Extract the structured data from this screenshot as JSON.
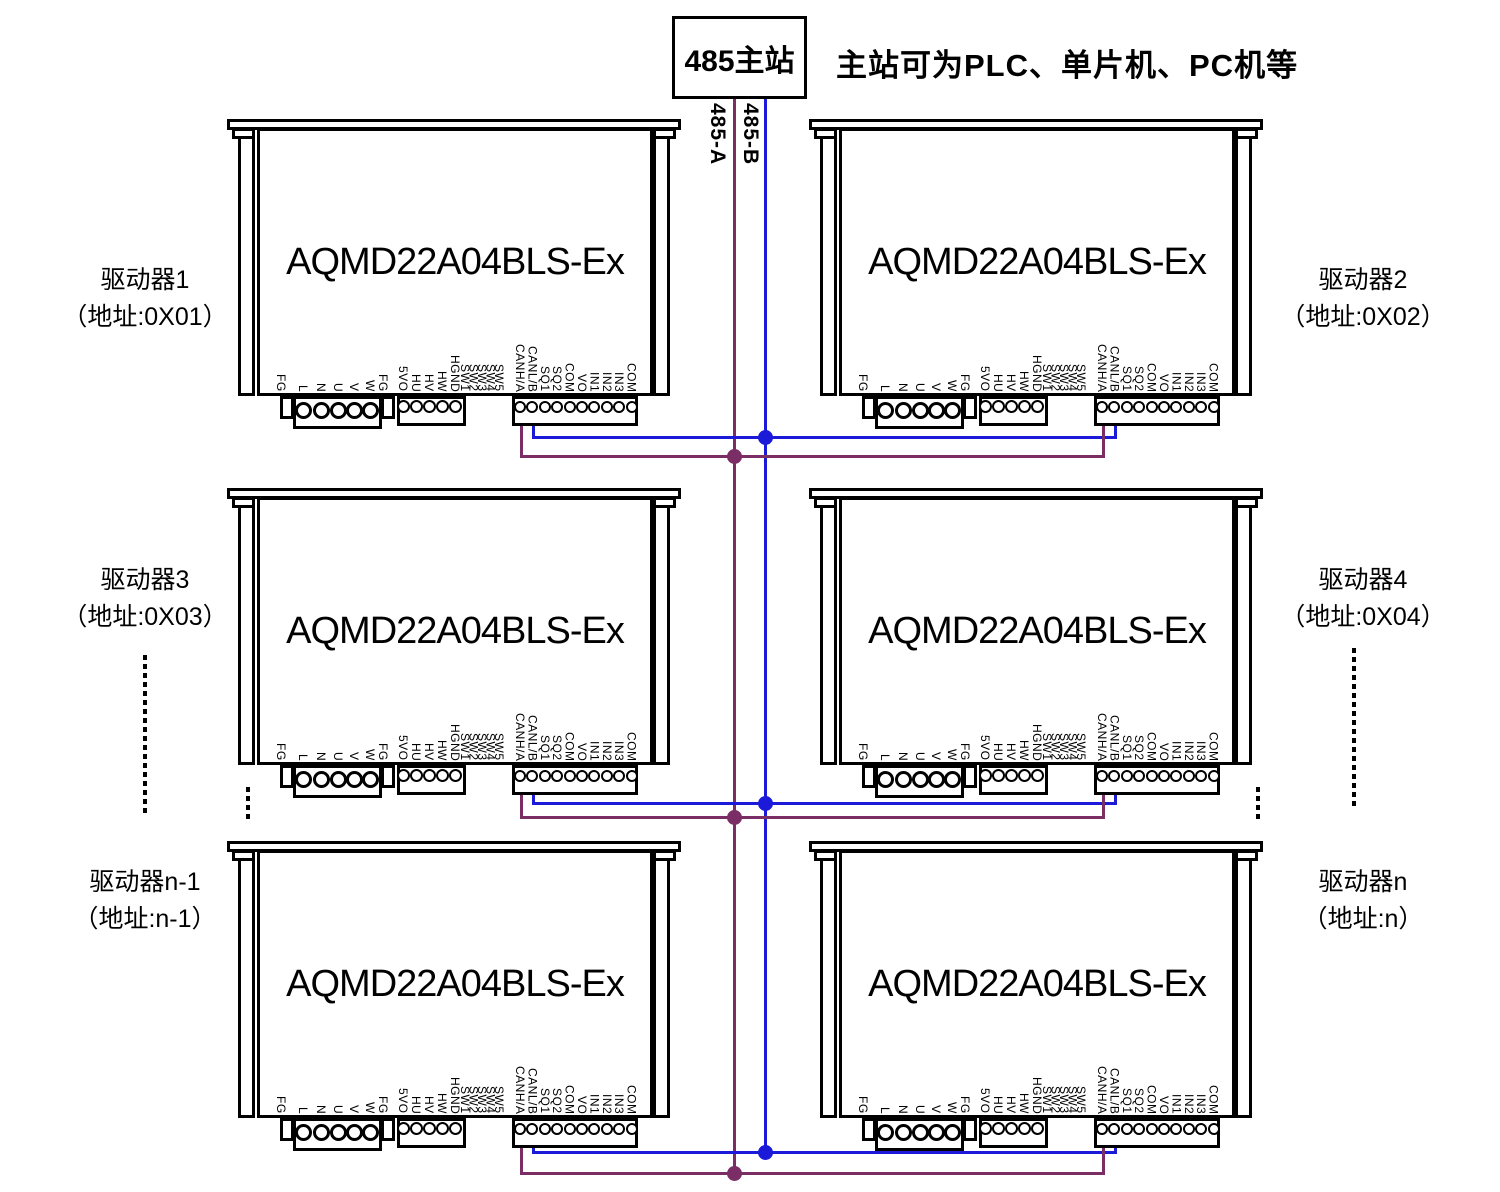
{
  "header": {
    "master_label": "485主站",
    "note": "主站可为PLC、单片机、PC机等"
  },
  "bus": {
    "a": {
      "label": "485-A",
      "color": "#7B2D66"
    },
    "b": {
      "label": "485-B",
      "color": "#1A1AD8"
    }
  },
  "module": {
    "title": "AQMD22A04BLS-Ex",
    "pins": {
      "power": [
        "FG",
        "L",
        "N",
        "U",
        "V",
        "W",
        "FG"
      ],
      "hall": [
        "5VO",
        "HU",
        "HV",
        "HW",
        "HGND"
      ],
      "dip": [
        "SW1",
        "SW2",
        "SW3",
        "SW4",
        "SW5"
      ],
      "control": [
        "CANH/A",
        "CANL/B",
        "SQ1",
        "SQ2",
        "COM",
        "VO",
        "IN1",
        "IN2",
        "IN3",
        "COM"
      ]
    }
  },
  "drivers": [
    {
      "name": "驱动器1",
      "addr": "（地址:0X01）"
    },
    {
      "name": "驱动器2",
      "addr": "（地址:0X02）"
    },
    {
      "name": "驱动器3",
      "addr": "（地址:0X03）"
    },
    {
      "name": "驱动器4",
      "addr": "（地址:0X04）"
    },
    {
      "name": "驱动器n-1",
      "addr": "（地址:n-1）"
    },
    {
      "name": "驱动器n",
      "addr": "（地址:n）"
    }
  ]
}
